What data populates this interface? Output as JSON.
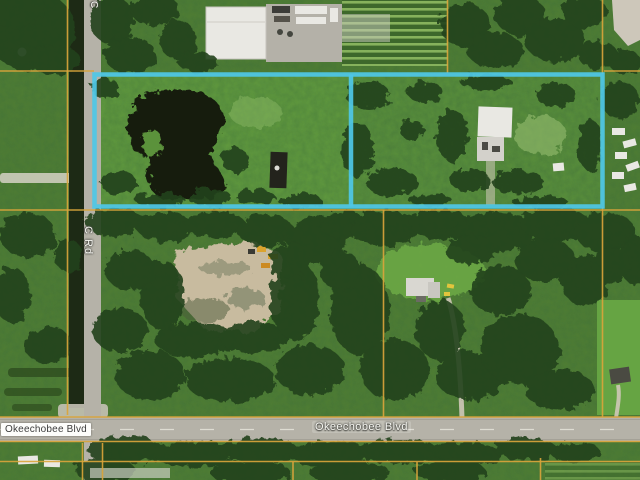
{
  "map": {
    "type": "aerial-satellite-photo-with-parcel-overlay",
    "labels": {
      "okeechobee_left": "Okeechobee Blvd",
      "okeechobee_center": "Okeechobee Blvd",
      "c_rd": "C Rd",
      "c_rd_top": "C"
    },
    "colors": {
      "boundary_highlight": "#4fc7e6",
      "parcel_line": "#d9a43b",
      "road_pavement": "#b5b2a8",
      "canal_water": "#1d2a15",
      "base_green": "#4f7d33",
      "parcel_grass": "#649f41",
      "tree_green": "#24421b",
      "sand_clearing": "#c8bb9f",
      "building_white": "#e9e8e3",
      "label_dark": "#3c3c3c"
    }
  }
}
